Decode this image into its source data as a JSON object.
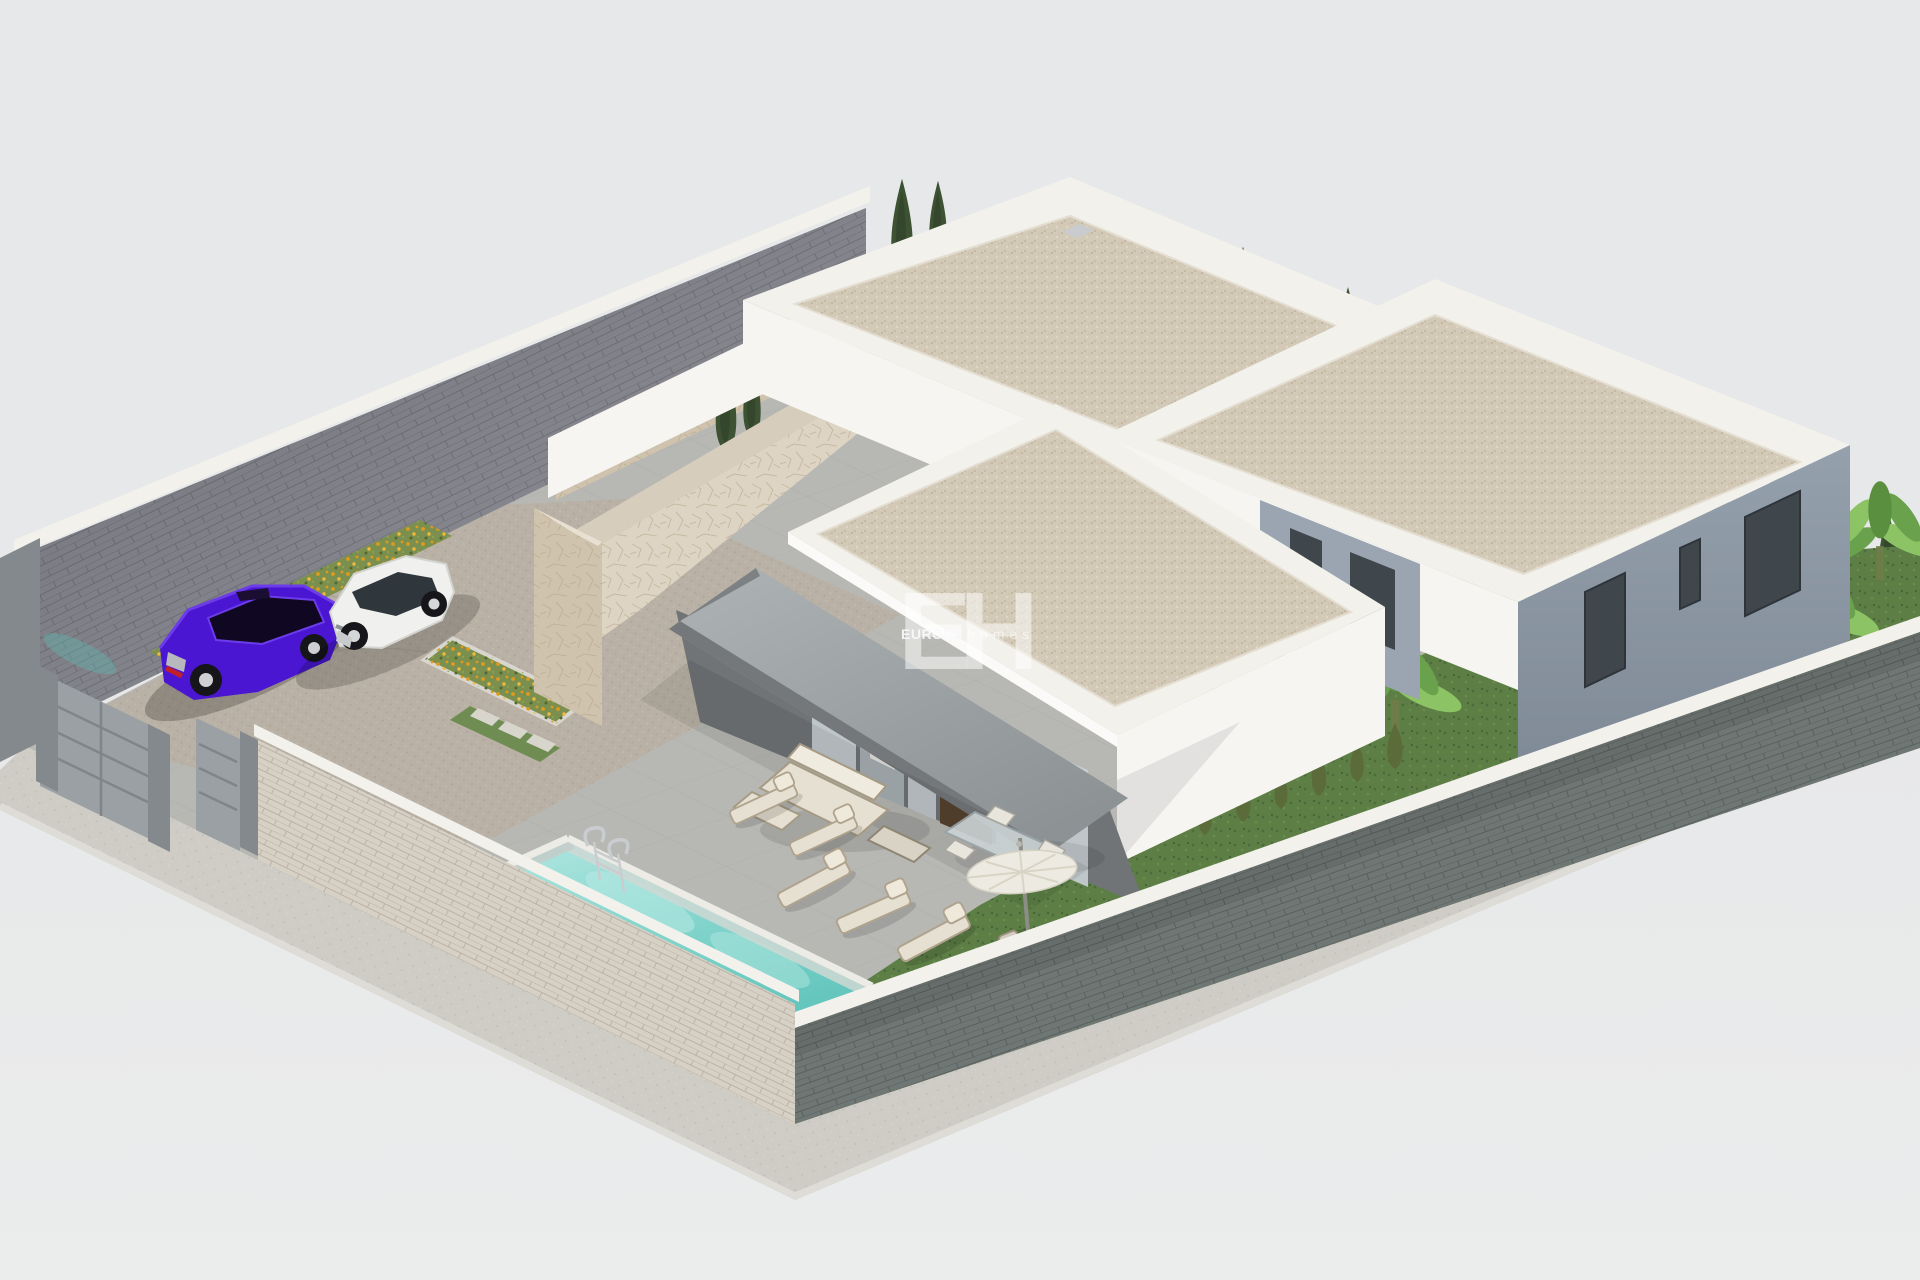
{
  "watermark": {
    "initials": "EH",
    "brand_primary": "EUROPE",
    "brand_secondary": "homes"
  },
  "scene": {
    "type": "3d-architectural-render",
    "subject": "Isometric render of a walled villa plot: three white flat-roofed volumes with gravel roofs, stone-clad feature walls, covered terrace, pool, parked cars, flower beds and tropical garden",
    "elements": [
      "perimeter-wall",
      "driveway-gate",
      "pedestrian-gate",
      "cobbled-driveway",
      "purple-sedan",
      "white-suv",
      "flower-beds",
      "stone-clad-wall",
      "stone-planter",
      "back-villa",
      "right-villa",
      "main-villa",
      "canopy-awning",
      "glass-sliding-doors",
      "timber-slat-door",
      "swimming-pool",
      "pool-ladder",
      "sun-loungers",
      "parasol",
      "outdoor-sofa-set",
      "dining-set",
      "lawn",
      "banana-plants",
      "cypress-hedge",
      "sidewalk"
    ]
  },
  "palette": {
    "bg": "#e7e8e9",
    "bg2": "#ebecec",
    "sidewalk": "#cfccc6",
    "curb": "#dedcd6",
    "plotbase": "#b7b8b4",
    "tileline": "#a5a6a2",
    "drive": "#b9b1a5",
    "driveline": "#a89f92",
    "wallback": "#96969d",
    "wallbackdark": "#6f6f78",
    "coping": "#f2f1ec",
    "wallfront": "#d7d1c5",
    "wallfrontlight": "#e3ded4",
    "gate": "#9aa0a4",
    "gatedark": "#83898d",
    "walldark": "#6f7774",
    "walldark2": "#5d6563",
    "whitelit": "#f6f5f2",
    "whitemid": "#edebe7",
    "whiteshade": "#dedcd7",
    "gravel": "#d3c9b7",
    "graveldot": "#bfb29c",
    "stone": "#ded4c3",
    "stonedark": "#cfc3ae",
    "stoneline": "#b3a386",
    "slate": "#95a0ad",
    "slatedark": "#7d8894",
    "glass": "#c5cdd1",
    "glassdark": "#3f464c",
    "awn": "#9aa0a2",
    "awndark": "#75787a",
    "wood": "#56432f",
    "lawn": "#5d7f46",
    "lawndark": "#48663a",
    "leaf": "#69a14c",
    "leaflight": "#8cc465",
    "cypress": "#3c5233",
    "cypressdark": "#2e4027",
    "flower": "#e09a1e",
    "flower2": "#f3b83a",
    "bedgreen": "#7b8f4e",
    "pool": "#8ad8d0",
    "poollight": "#b8e9e3",
    "pooldeep": "#64c6bd",
    "purple": "#4a16d2",
    "purpledark": "#35099e",
    "purplelight": "#6d3cea",
    "carwhite": "#f0f0ee",
    "carwhiteshade": "#d8d8d6",
    "chrome": "#c9cdd0",
    "cushion": "#e6e0d2",
    "framewood": "#b0a38e"
  }
}
